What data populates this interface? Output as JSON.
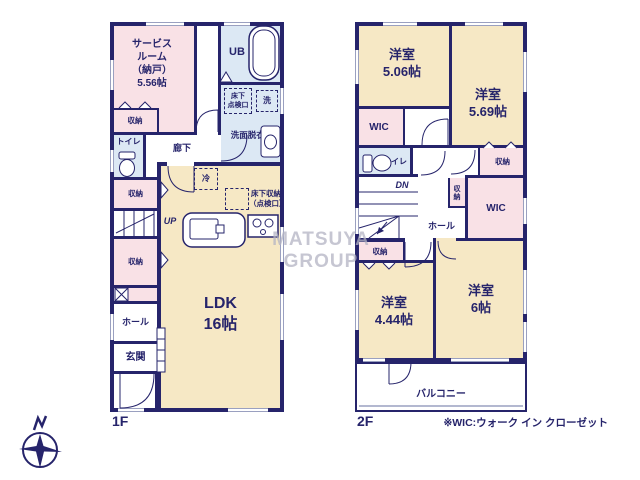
{
  "watermark": "MATSUYA GROUP",
  "note": "※WIC:ウォーク イン クローゼット",
  "f1": {
    "floor_label": "1F",
    "service_room": "サービス\nルーム\n（納戸）\n5.56帖",
    "closet1": "収納",
    "toilet": "トイレ",
    "corridor": "廊下",
    "ub": "UB",
    "underfloor_access": "床下\n点検口",
    "washer": "洗",
    "washroom": "洗面脱衣室",
    "fridge": "冷",
    "closet2": "収納",
    "stairs": "UP",
    "closet3": "収納",
    "hall": "ホール",
    "entrance": "玄関",
    "ldk": "LDK\n16帖",
    "underfloor_storage": "床下収納\n（点検口）"
  },
  "f2": {
    "floor_label": "2F",
    "room_a": "洋室\n5.06帖",
    "room_b": "洋室\n5.69帖",
    "wic_a": "WIC",
    "toilet": "トイレ",
    "closet_a": "収納",
    "stairs": "DN",
    "hall": "ホール",
    "closet_b": "収納",
    "wic_b": "WIC",
    "closet_c": "収納",
    "room_c": "洋室\n4.44帖",
    "room_d": "洋室\n6帖",
    "balcony": "バルコニー"
  },
  "colors": {
    "wall": "#26246b",
    "room_cream": "#f6e8c5",
    "room_pink": "#f9e1e6",
    "room_blue": "#dce8f4",
    "text": "#26246b",
    "watermark": "#b4b4c4"
  }
}
